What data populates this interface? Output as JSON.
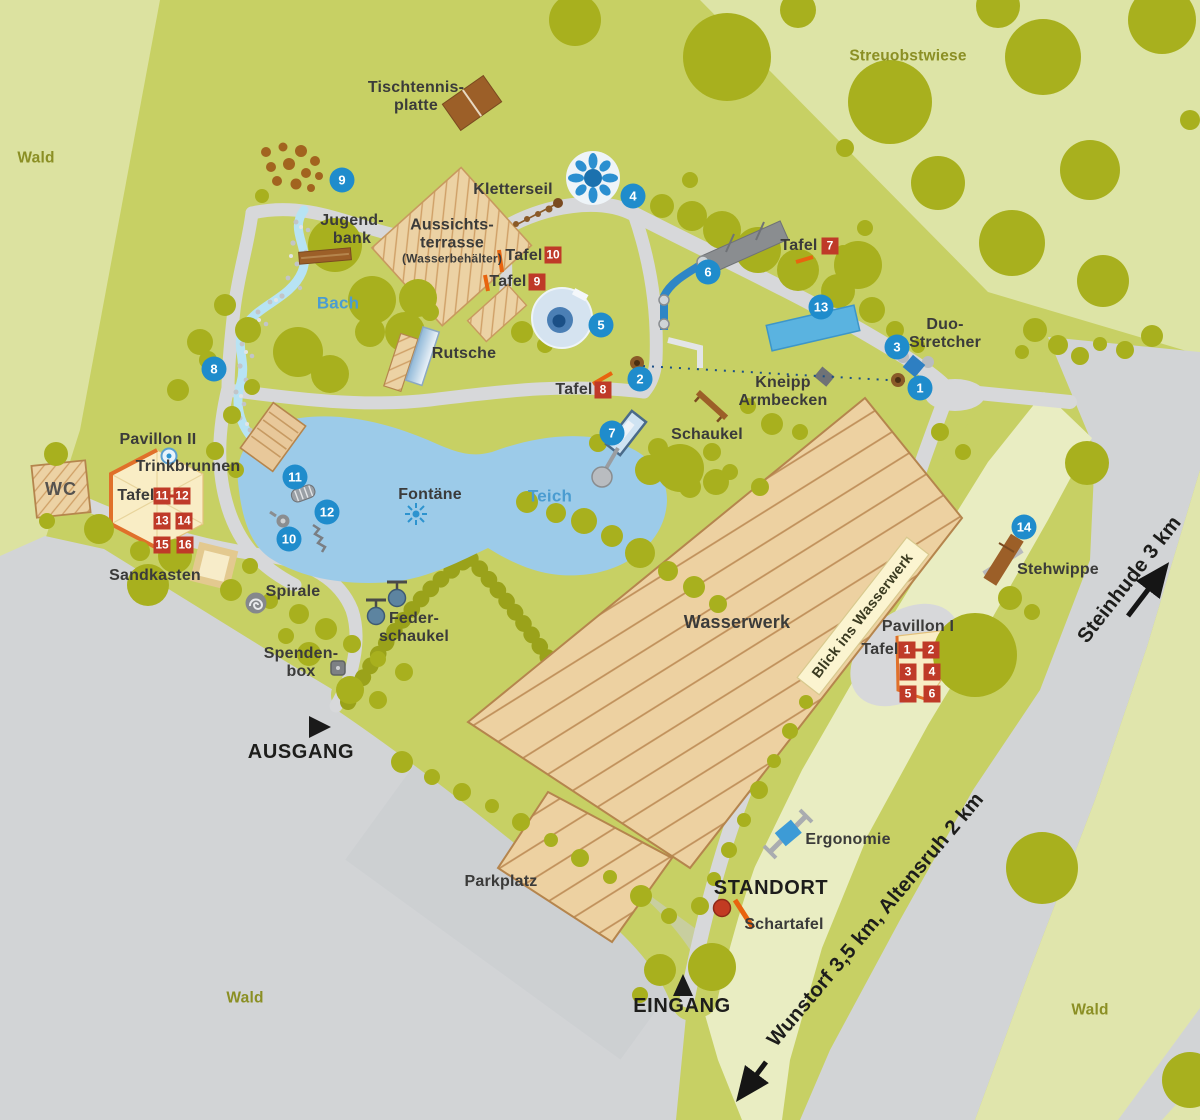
{
  "map": {
    "areas": {
      "wald": "Wald",
      "streuobstwiese": "Streuobstwiese",
      "parkplatz": "Parkplatz"
    },
    "water": {
      "bach": "Bach",
      "teich": "Teich"
    },
    "labels": {
      "tischtennisplatte": "Tischtennis-\nplatte",
      "kletterseil": "Kletterseil",
      "jugendbank": "Jugend-\nbank",
      "aussichtsterrasse": "Aussichts-\nterrasse",
      "aussichtsterrasse_sub": "(Wasserbehälter)",
      "tafel": "Tafel",
      "rutsche": "Rutsche",
      "duo_stretcher": "Duo-\nStretcher",
      "kneipp_armbecken": "Kneipp\nArmbecken",
      "schaukel": "Schaukel",
      "pavillon_2": "Pavillon II",
      "trinkbrunnen": "Trinkbrunnen",
      "wc": "WC",
      "sandkasten": "Sandkasten",
      "spirale": "Spirale",
      "federschaukel": "Feder-\nschaukel",
      "spendenbox": "Spenden-\nbox",
      "fontaene": "Fontäne",
      "wasserwerk": "Wasserwerk",
      "blick_ins_wasserwerk": "Blick ins Wasserwerk",
      "pavillon_1": "Pavillon I",
      "stehwippe": "Stehwippe",
      "ergonomie": "Ergonomie",
      "standort": "STANDORT",
      "schartafel": "Schartafel",
      "eingang": "EINGANG",
      "ausgang": "AUSGANG"
    },
    "roads": {
      "steinhude": "Steinhude 3 km",
      "wunstorf": "Wunstorf 3,5 km, Altensruh 2 km"
    },
    "markers": {
      "numbered": [
        {
          "n": "1",
          "x": 920,
          "y": 388
        },
        {
          "n": "2",
          "x": 640,
          "y": 379
        },
        {
          "n": "3",
          "x": 897,
          "y": 347
        },
        {
          "n": "4",
          "x": 633,
          "y": 196
        },
        {
          "n": "5",
          "x": 601,
          "y": 325
        },
        {
          "n": "6",
          "x": 708,
          "y": 272
        },
        {
          "n": "7",
          "x": 612,
          "y": 433
        },
        {
          "n": "8",
          "x": 214,
          "y": 369
        },
        {
          "n": "9",
          "x": 342,
          "y": 180
        },
        {
          "n": "10",
          "x": 289,
          "y": 539
        },
        {
          "n": "11",
          "x": 295,
          "y": 477
        },
        {
          "n": "12",
          "x": 327,
          "y": 512
        },
        {
          "n": "13",
          "x": 821,
          "y": 307
        },
        {
          "n": "14",
          "x": 1024,
          "y": 527
        }
      ],
      "tafel": [
        {
          "n": "10",
          "x": 553,
          "y": 255
        },
        {
          "n": "9",
          "x": 537,
          "y": 282
        },
        {
          "n": "8",
          "x": 603,
          "y": 390
        },
        {
          "n": "7",
          "x": 830,
          "y": 246
        },
        {
          "n": "11",
          "x": 162,
          "y": 496
        },
        {
          "n": "12",
          "x": 182,
          "y": 496
        },
        {
          "n": "13",
          "x": 162,
          "y": 521
        },
        {
          "n": "14",
          "x": 184,
          "y": 521
        },
        {
          "n": "15",
          "x": 162,
          "y": 545
        },
        {
          "n": "16",
          "x": 185,
          "y": 545
        },
        {
          "n": "1",
          "x": 907,
          "y": 650
        },
        {
          "n": "2",
          "x": 931,
          "y": 650
        },
        {
          "n": "3",
          "x": 908,
          "y": 672
        },
        {
          "n": "4",
          "x": 932,
          "y": 672
        },
        {
          "n": "5",
          "x": 908,
          "y": 694
        },
        {
          "n": "6",
          "x": 932,
          "y": 694
        }
      ],
      "dashes": [
        {
          "x": 172,
          "y": 496
        },
        {
          "x": 919,
          "y": 650
        }
      ]
    },
    "colors": {
      "park_green": "#c7d064",
      "pale_green": "#dce2a0",
      "strip_pale": "#e9edc2",
      "tree_olive": "#a8b01e",
      "hedge_olive": "#9aa21a",
      "path_gray": "#d7d8da",
      "road_gray": "#d2d4d6",
      "pond_blue": "#9ccbe9",
      "pool_blue": "#5ab3e0",
      "stream_blue": "#b7e3f4",
      "building_tan": "#edd1a1",
      "building_line": "#b5854d",
      "pavilion_cream": "#f9edc5",
      "pavilion_orange": "#e0702a",
      "badge_red": "#bf3a28",
      "badge_blue": "#1f8ccc",
      "water_text": "#4a9cd1",
      "area_text": "#8b8f24",
      "dark_text": "#3b3b3a",
      "orange_tick": "#e8640f",
      "standort_red": "#c23b22"
    }
  }
}
